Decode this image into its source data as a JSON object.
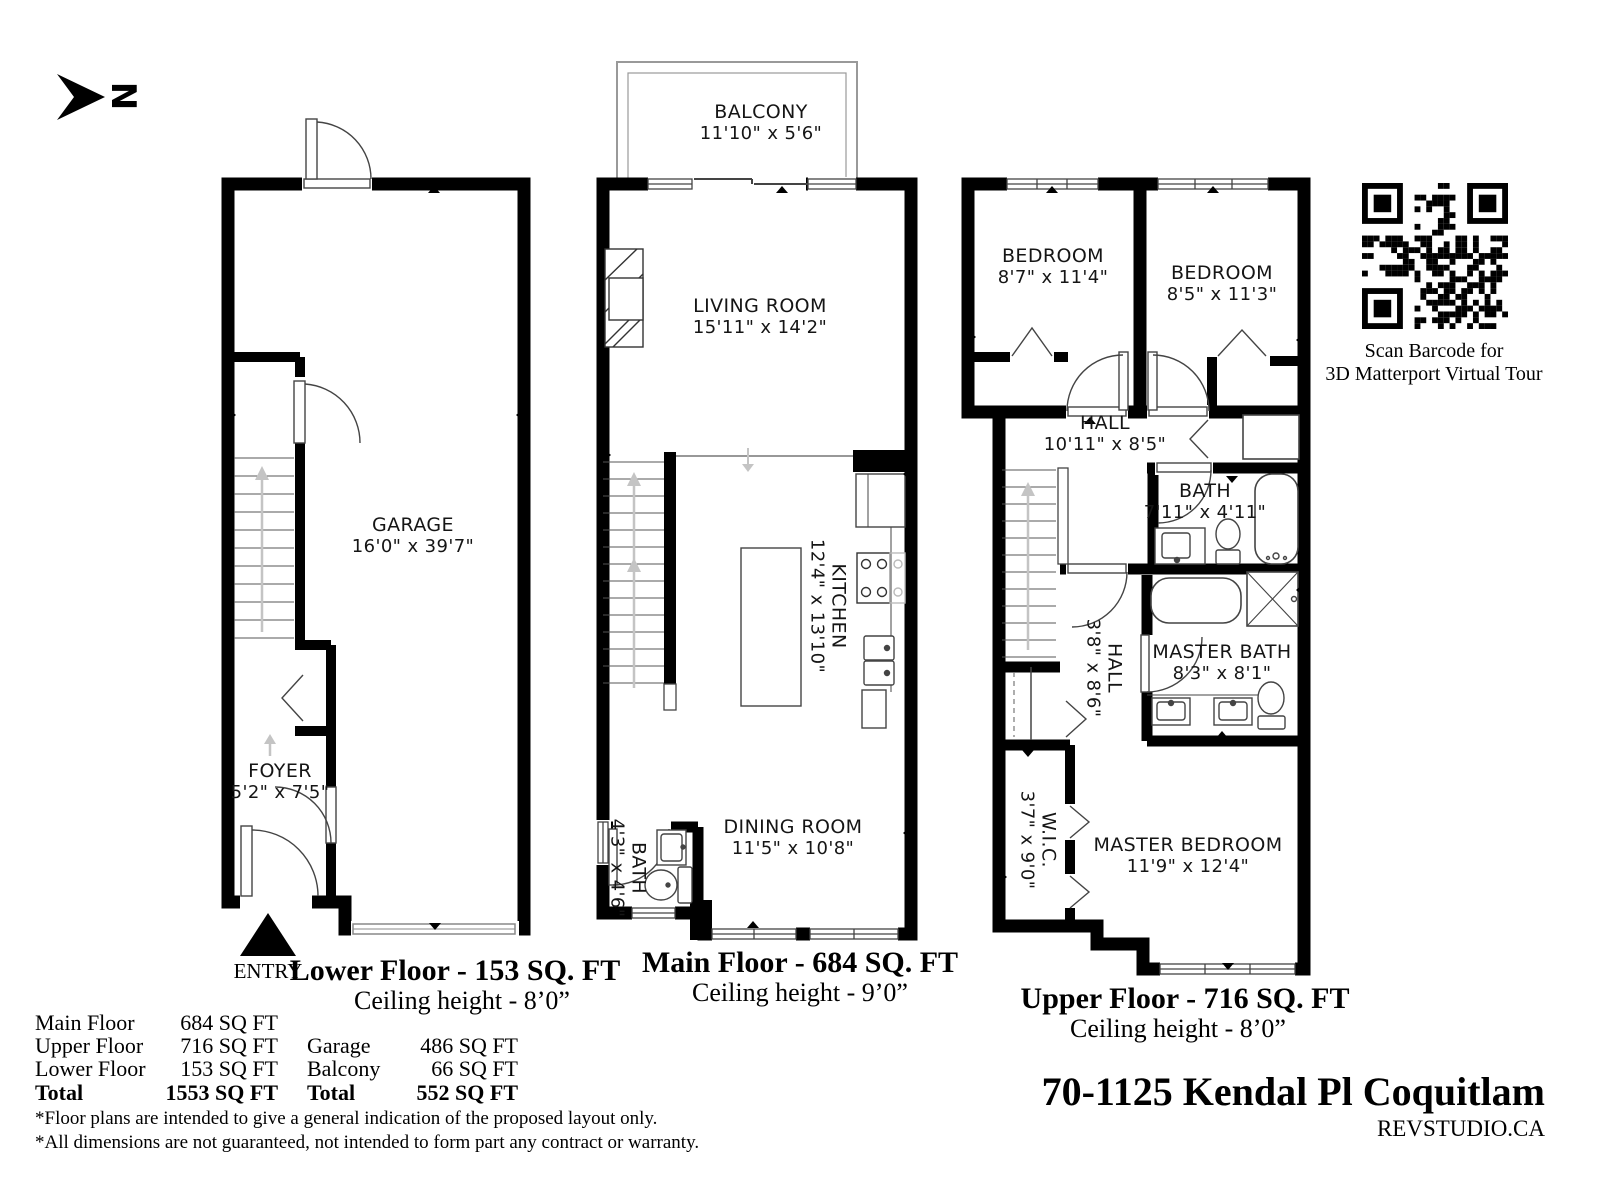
{
  "north": {
    "label": "N"
  },
  "colors": {
    "wall": "#000000",
    "fixture_line": "#444444",
    "stair_arrow": "#c4c4c4",
    "balcony_line": "#999999"
  },
  "plans": {
    "lower": {
      "title": "Lower Floor - 153 SQ. FT",
      "ceiling": "Ceiling height - 8’0”",
      "entry_label": "ENTRY",
      "rooms": {
        "garage": {
          "name": "GARAGE",
          "dims": "16'0\" x 39'7\""
        },
        "foyer": {
          "name": "FOYER",
          "dims": "5'2\" x 7'5\""
        }
      }
    },
    "main": {
      "title": "Main Floor - 684 SQ. FT",
      "ceiling": "Ceiling height - 9’0”",
      "rooms": {
        "balcony": {
          "name": "BALCONY",
          "dims": "11'10\" x 5'6\""
        },
        "living": {
          "name": "LIVING ROOM",
          "dims": "15'11\" x 14'2\""
        },
        "kitchen": {
          "name": "KITCHEN",
          "dims": "12'4\" x 13'10\""
        },
        "dining": {
          "name": "DINING ROOM",
          "dims": "11'5\" x 10'8\""
        },
        "bath": {
          "name": "BATH",
          "dims": "4'3\" x 4'6\""
        }
      }
    },
    "upper": {
      "title": "Upper Floor - 716 SQ. FT",
      "ceiling": "Ceiling height - 8’0”",
      "rooms": {
        "bedroom1": {
          "name": "BEDROOM",
          "dims": "8'7\" x 11'4\""
        },
        "bedroom2": {
          "name": "BEDROOM",
          "dims": "8'5\" x 11'3\""
        },
        "hall": {
          "name": "HALL",
          "dims": "10'11\" x 8'5\""
        },
        "bath": {
          "name": "BATH",
          "dims": "7'11\" x 4'11\""
        },
        "hall2": {
          "name": "HALL",
          "dims": "3'8\" x 8'6\""
        },
        "master_bath": {
          "name": "MASTER BATH",
          "dims": "8'3\" x 8'1\""
        },
        "wic": {
          "name": "W.I.C.",
          "dims": "3'7\" x 9'0\""
        },
        "master_bedroom": {
          "name": "MASTER BEDROOM",
          "dims": "11'9\" x 12'4\""
        }
      }
    }
  },
  "qr": {
    "caption_line1": "Scan Barcode for",
    "caption_line2": "3D Matterport Virtual Tour"
  },
  "area_summary": {
    "left_rows": [
      {
        "label": "Main Floor",
        "value": "684 SQ FT"
      },
      {
        "label": "Upper Floor",
        "value": "716 SQ FT"
      },
      {
        "label": "Lower Floor",
        "value": "153 SQ FT"
      },
      {
        "label": "Total",
        "value": "1553 SQ FT"
      }
    ],
    "right_rows": [
      {
        "label": "Garage",
        "value": "486 SQ FT"
      },
      {
        "label": "Balcony",
        "value": "66 SQ FT"
      },
      {
        "label": "Total",
        "value": "552 SQ FT"
      }
    ]
  },
  "disclaimers": [
    "*Floor plans are intended to give a general indication of the proposed layout only.",
    "*All dimensions are not guaranteed, not intended to form part any contract or warranty."
  ],
  "footer": {
    "address": "70-1125 Kendal Pl Coquitlam",
    "brand": "REVSTUDIO.CA"
  }
}
